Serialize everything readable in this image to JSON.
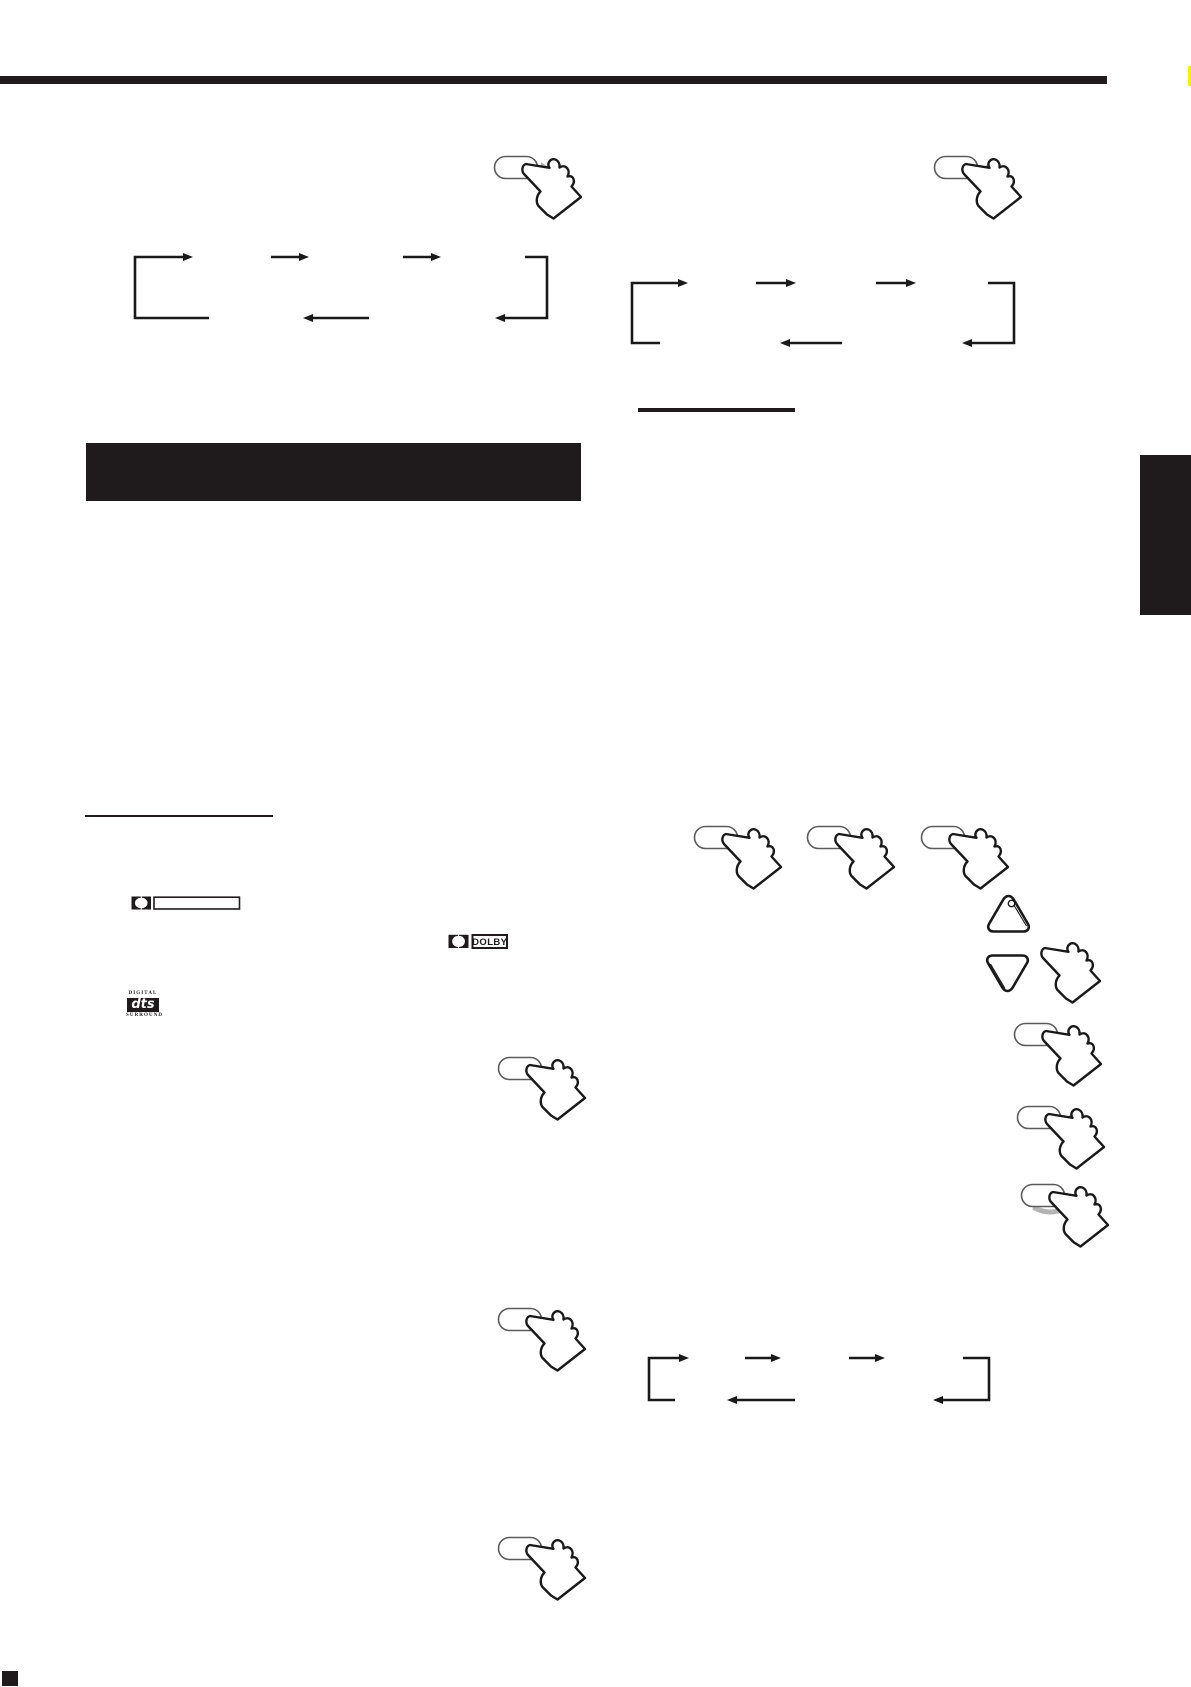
{
  "canvas": {
    "width": 1191,
    "height": 1687,
    "background": "#ffffff"
  },
  "colors": {
    "ink": "#1f1b1c",
    "line": "#191919",
    "indicator_gray": "#b4b4b4",
    "edge_highlight_yellow": "#f8ef0c"
  },
  "page_graphics": {
    "top_rule": "full-width horizontal black rule under (stripped) page header",
    "section_title_bar": {
      "text": "",
      "note": "solid black section heading bar, no legible text"
    },
    "side_tab": {
      "text": "",
      "note": "black section thumb-tab on right page edge"
    },
    "left_column_heading_underline": "thin underline of stripped heading",
    "right_column_heading_underline": "thick short underline of stripped heading",
    "note_marker": "small black square at bottom-left (footnote marker)"
  },
  "logos": {
    "dolby_digital_line": {
      "symbol": "double-d",
      "box_text": ""
    },
    "dolby_boxed": {
      "symbol": "double-d",
      "box_text": "DOLBY"
    },
    "dts": {
      "top": "DIGITAL",
      "mid": "dts",
      "bottom": "SURROUND"
    }
  },
  "figures": {
    "hands": [
      {
        "name": "press-hand-top-left",
        "x": 493,
        "y": 150,
        "button": true,
        "indicator": "right"
      },
      {
        "name": "press-hand-top-right",
        "x": 933,
        "y": 150,
        "button": true,
        "indicator": "left"
      },
      {
        "name": "press-hand-row-1",
        "x": 693,
        "y": 820,
        "button": true,
        "indicator": "none"
      },
      {
        "name": "press-hand-row-2",
        "x": 806,
        "y": 820,
        "button": true,
        "indicator": "none"
      },
      {
        "name": "press-hand-row-3",
        "x": 920,
        "y": 820,
        "button": true,
        "indicator": "none"
      },
      {
        "name": "press-hand-cursor",
        "x": 1038,
        "y": 938,
        "button": false,
        "indicator": "none"
      },
      {
        "name": "press-hand-right-1",
        "x": 1013,
        "y": 1017,
        "button": true,
        "indicator": "none"
      },
      {
        "name": "press-hand-right-2",
        "x": 1016,
        "y": 1100,
        "button": true,
        "indicator": "left"
      },
      {
        "name": "press-hand-right-3",
        "x": 1020,
        "y": 1178,
        "button": true,
        "indicator": "shadow"
      },
      {
        "name": "press-hand-left-1",
        "x": 497,
        "y": 1051,
        "button": true,
        "indicator": "none"
      },
      {
        "name": "press-hand-left-2",
        "x": 497,
        "y": 1302,
        "button": true,
        "indicator": "none"
      },
      {
        "name": "press-hand-left-3",
        "x": 497,
        "y": 1531,
        "button": true,
        "indicator": "none"
      }
    ],
    "cycle_diagrams": [
      {
        "name": "cycle-diagram-left-top",
        "arrows": "3 forward (top), return path (bottom)"
      },
      {
        "name": "cycle-diagram-right-top",
        "arrows": "3 forward (top), return path (bottom)"
      },
      {
        "name": "cycle-diagram-bottom",
        "arrows": "3 forward (top), return path (bottom)"
      }
    ],
    "triangle_buttons": {
      "up": "rounded triangle with indicator dot",
      "down": "rounded triangle"
    }
  }
}
